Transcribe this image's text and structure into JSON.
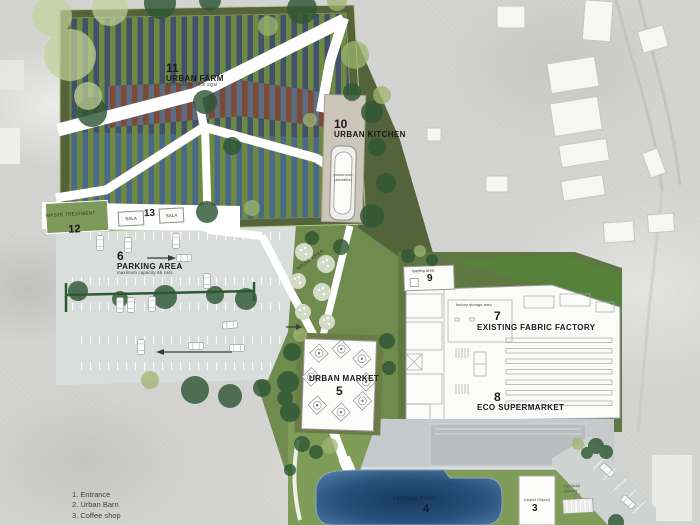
{
  "labels": {
    "farm": {
      "num": "11",
      "name": "URBAN FARM",
      "sub": "TOTAL AREA 4000 SQM"
    },
    "kitchen": {
      "num": "10",
      "name": "URBAN KITCHEN"
    },
    "mushroom": "mushroom plantation",
    "waste": {
      "num": "12",
      "name": "WASTE TREATMENT"
    },
    "sala_left": "SALA",
    "sala_num": "13",
    "sala_right": "SALA",
    "parking": {
      "num": "6",
      "name": "PARKING AREA",
      "sub": "maximum capacity 65 cars"
    },
    "noise": "NOISE AREA",
    "loading": {
      "num": "9",
      "name": "loading area"
    },
    "storage": "factory storage area",
    "factory": {
      "num": "7",
      "name": "EXISTING FABRIC FACTORY"
    },
    "supermarket": {
      "num": "8",
      "name": "ECO SUPERMARKET"
    },
    "market": {
      "num": "5",
      "name": "URBAN MARKET"
    },
    "pond": {
      "num": "4",
      "name": "EXISTING POND"
    },
    "coffee": {
      "num": "3",
      "name": "coffee store"
    },
    "handicap": "handicap parking"
  },
  "legend": {
    "items": [
      "1. Entrance",
      "2. Urban Barn",
      "3. Coffee shop"
    ]
  },
  "colors": {
    "crop_green": "#6d8a40",
    "soil_brown": "#7c4a36",
    "field_blue": "#49688a",
    "pond_blue": "#1c3e64",
    "lawn_green": "#7f9b58",
    "parking_gray": "#d9dddb",
    "path_white": "#ffffff",
    "tree_dark": "#2f5735"
  }
}
